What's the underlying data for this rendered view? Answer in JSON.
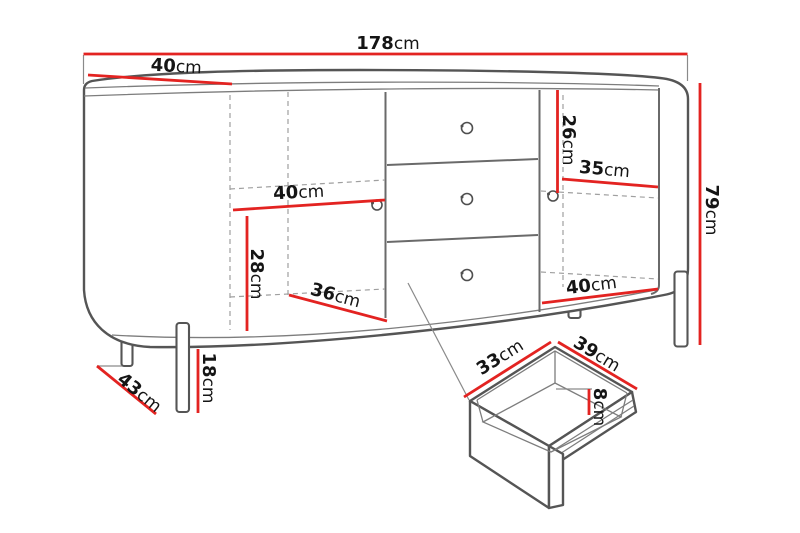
{
  "diagram": {
    "kind": "furniture-dimension-diagram",
    "unit": "cm",
    "palette": {
      "dimension_red": "#e32321",
      "outline_gray": "#555555",
      "dashed_gray": "#9f9f9f",
      "background": "#ffffff",
      "text": "#151515"
    },
    "overall": {
      "width_cm": 178,
      "depth_cm": 40,
      "height_cm": 79
    },
    "dimensions": [
      {
        "id": "total-width",
        "value": "178",
        "unit": "cm"
      },
      {
        "id": "top-depth",
        "value": "40",
        "unit": "cm"
      },
      {
        "id": "right-upper-height",
        "value": "26",
        "unit": "cm"
      },
      {
        "id": "right-shelf-width",
        "value": "35",
        "unit": "cm"
      },
      {
        "id": "total-height",
        "value": "79",
        "unit": "cm"
      },
      {
        "id": "left-shelf-width",
        "value": "40",
        "unit": "cm"
      },
      {
        "id": "left-lower-height",
        "value": "28",
        "unit": "cm"
      },
      {
        "id": "left-bottom-width",
        "value": "36",
        "unit": "cm"
      },
      {
        "id": "right-bottom-width",
        "value": "40",
        "unit": "cm"
      },
      {
        "id": "leg-height",
        "value": "18",
        "unit": "cm"
      },
      {
        "id": "floor-depth",
        "value": "43",
        "unit": "cm"
      },
      {
        "id": "drawer-depth",
        "value": "33",
        "unit": "cm"
      },
      {
        "id": "drawer-width",
        "value": "39",
        "unit": "cm"
      },
      {
        "id": "drawer-inner-height",
        "value": "8",
        "unit": "cm"
      }
    ]
  }
}
